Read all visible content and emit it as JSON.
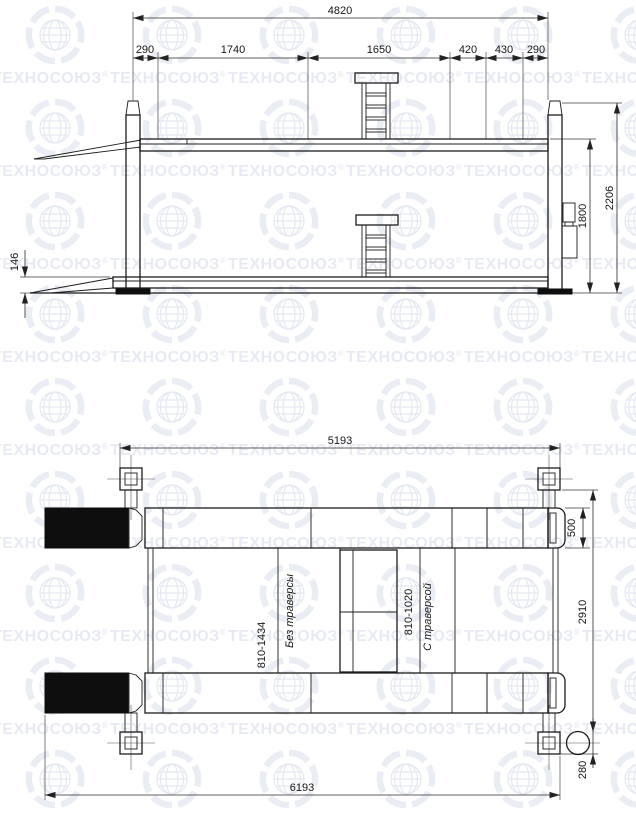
{
  "watermark": {
    "text": "ТЕХНОСОЮЗ",
    "reg": "®"
  },
  "elevation": {
    "dim_total_width": "4820",
    "segments": [
      "290",
      "1740",
      "1650",
      "420",
      "430",
      "290"
    ],
    "dim_height_total": "2206",
    "dim_height_platform": "1800",
    "dim_min_height": "146"
  },
  "plan": {
    "dim_posts_span": "5193",
    "dim_overall_length": "6193",
    "dim_runway_width": "500",
    "dim_track_width": "2910",
    "dim_motor": "280",
    "label_no_traverse_range": "810-1434",
    "label_no_traverse": "Без траверсы",
    "label_with_traverse_range": "810-1020",
    "label_with_traverse": "С траверсой"
  }
}
